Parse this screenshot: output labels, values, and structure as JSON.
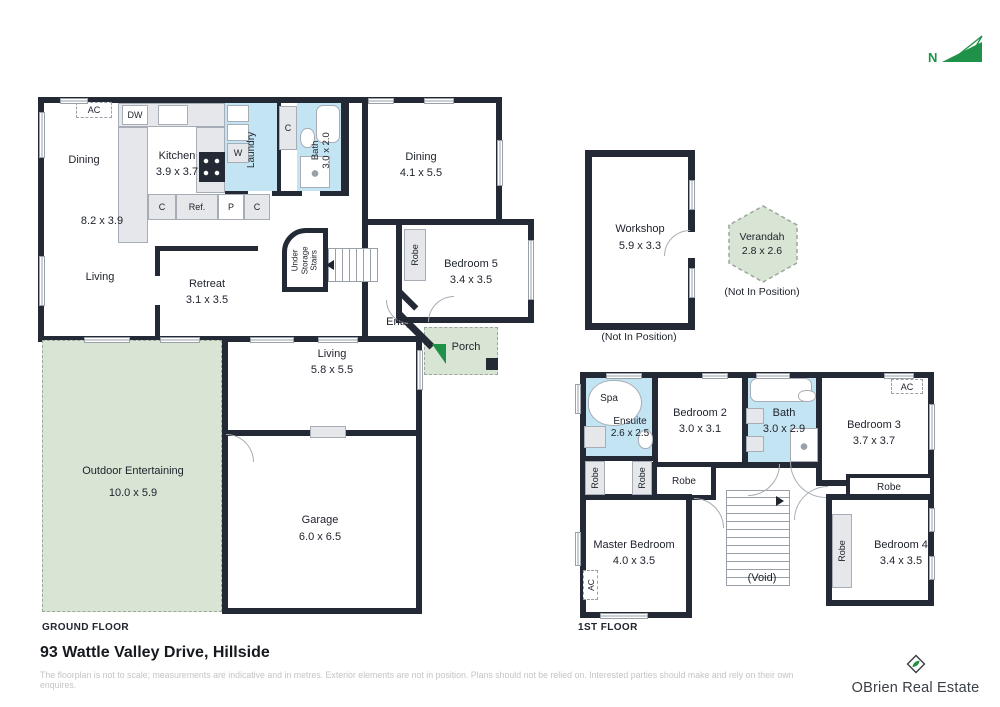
{
  "page": {
    "title": "93 Wattle Valley Drive, Hillside",
    "disclaimer": "The floorplan is not to scale; measurements are indicative and in metres. Exterior elements are not in position. Plans should not be relied on. Interested parties should make and rely on their own enquires.",
    "brand": "OBrien Real Estate",
    "north": "N"
  },
  "colors": {
    "wall": "#242a35",
    "wet_area": "#c3e4f2",
    "outdoor_area": "#d8e4d4",
    "accent_green": "#1f9148"
  },
  "ground": {
    "floor_label": "GROUND FLOOR",
    "dining_a": {
      "label": "Dining"
    },
    "kitchen": {
      "label": "Kitchen",
      "dims": "3.9 x 3.7"
    },
    "open_plan": {
      "dims": "8.2 x 3.9"
    },
    "living_a": {
      "label": "Living"
    },
    "retreat": {
      "label": "Retreat",
      "dims": "3.1 x 3.5"
    },
    "laundry": {
      "label": "Laundry"
    },
    "bath": {
      "label": "Bath",
      "dims": "3.0 x 2.0"
    },
    "under_stairs": {
      "label": "Under Storage Stairs"
    },
    "dining_b": {
      "label": "Dining",
      "dims": "4.1 x 5.5"
    },
    "bedroom5": {
      "label": "Bedroom 5",
      "dims": "3.4 x 3.5"
    },
    "robe": {
      "label": "Robe"
    },
    "entry": {
      "label": "Entry"
    },
    "porch": {
      "label": "Porch"
    },
    "living_b": {
      "label": "Living",
      "dims": "5.8 x 5.5"
    },
    "outdoor": {
      "label": "Outdoor Entertaining",
      "dims": "10.0 x 5.9"
    },
    "garage": {
      "label": "Garage",
      "dims": "6.0 x 6.5"
    },
    "fixtures": {
      "ac": "AC",
      "dw": "DW",
      "w": "W",
      "c1": "C",
      "c2": "C",
      "c3": "C",
      "ref": "Ref.",
      "p": "P"
    }
  },
  "outbuildings": {
    "workshop": {
      "label": "Workshop",
      "dims": "5.9 x 3.3",
      "note": "(Not In Position)"
    },
    "verandah": {
      "label": "Verandah",
      "dims": "2.8 x 2.6",
      "note": "(Not In Position)"
    }
  },
  "first": {
    "floor_label": "1ST FLOOR",
    "spa": {
      "label": "Spa"
    },
    "ensuite": {
      "label": "Ensuite",
      "dims": "2.6 x 2.5"
    },
    "bedroom2": {
      "label": "Bedroom 2",
      "dims": "3.0 x 3.1"
    },
    "bath": {
      "label": "Bath",
      "dims": "3.0 x 2.9"
    },
    "bedroom3": {
      "label": "Bedroom 3",
      "dims": "3.7 x 3.7"
    },
    "master": {
      "label": "Master Bedroom",
      "dims": "4.0 x 3.5"
    },
    "bedroom4": {
      "label": "Bedroom 4",
      "dims": "3.4 x 3.5"
    },
    "void": {
      "label": "(Void)"
    },
    "robe1": "Robe",
    "robe2": "Robe",
    "robe3": "Robe",
    "robe4": "Robe",
    "robe5": "Robe",
    "ac1": "AC",
    "ac2": "AC"
  }
}
